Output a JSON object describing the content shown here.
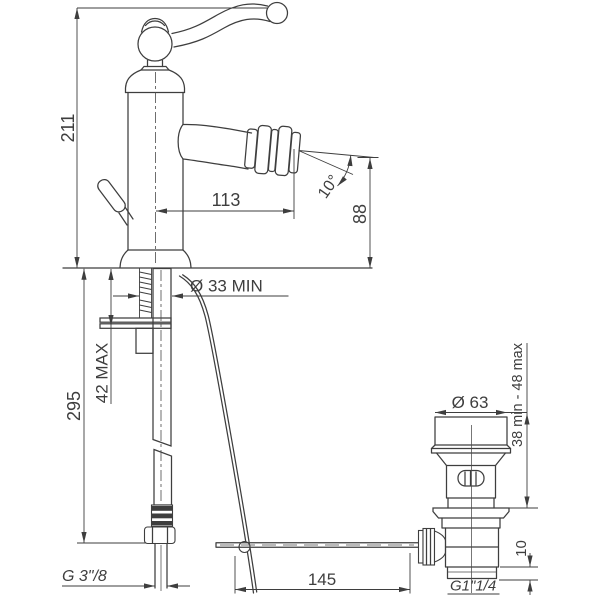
{
  "colors": {
    "line": "#3e3e3e",
    "background": "#ffffff"
  },
  "dimensions": {
    "total_height": "211",
    "spout_reach": "113",
    "spout_angle": "10°",
    "spout_height": "88",
    "mounting_hole": "Ø 33 MIN",
    "deck_thickness": "42 MAX",
    "supply_length": "295",
    "drain_flange": "Ø 63",
    "drain_deck_range": "38 min - 48 max",
    "drain_tail": "10",
    "rod_reach": "145",
    "supply_thread": "G 3\"/8",
    "drain_thread": "G1\"1/4"
  }
}
